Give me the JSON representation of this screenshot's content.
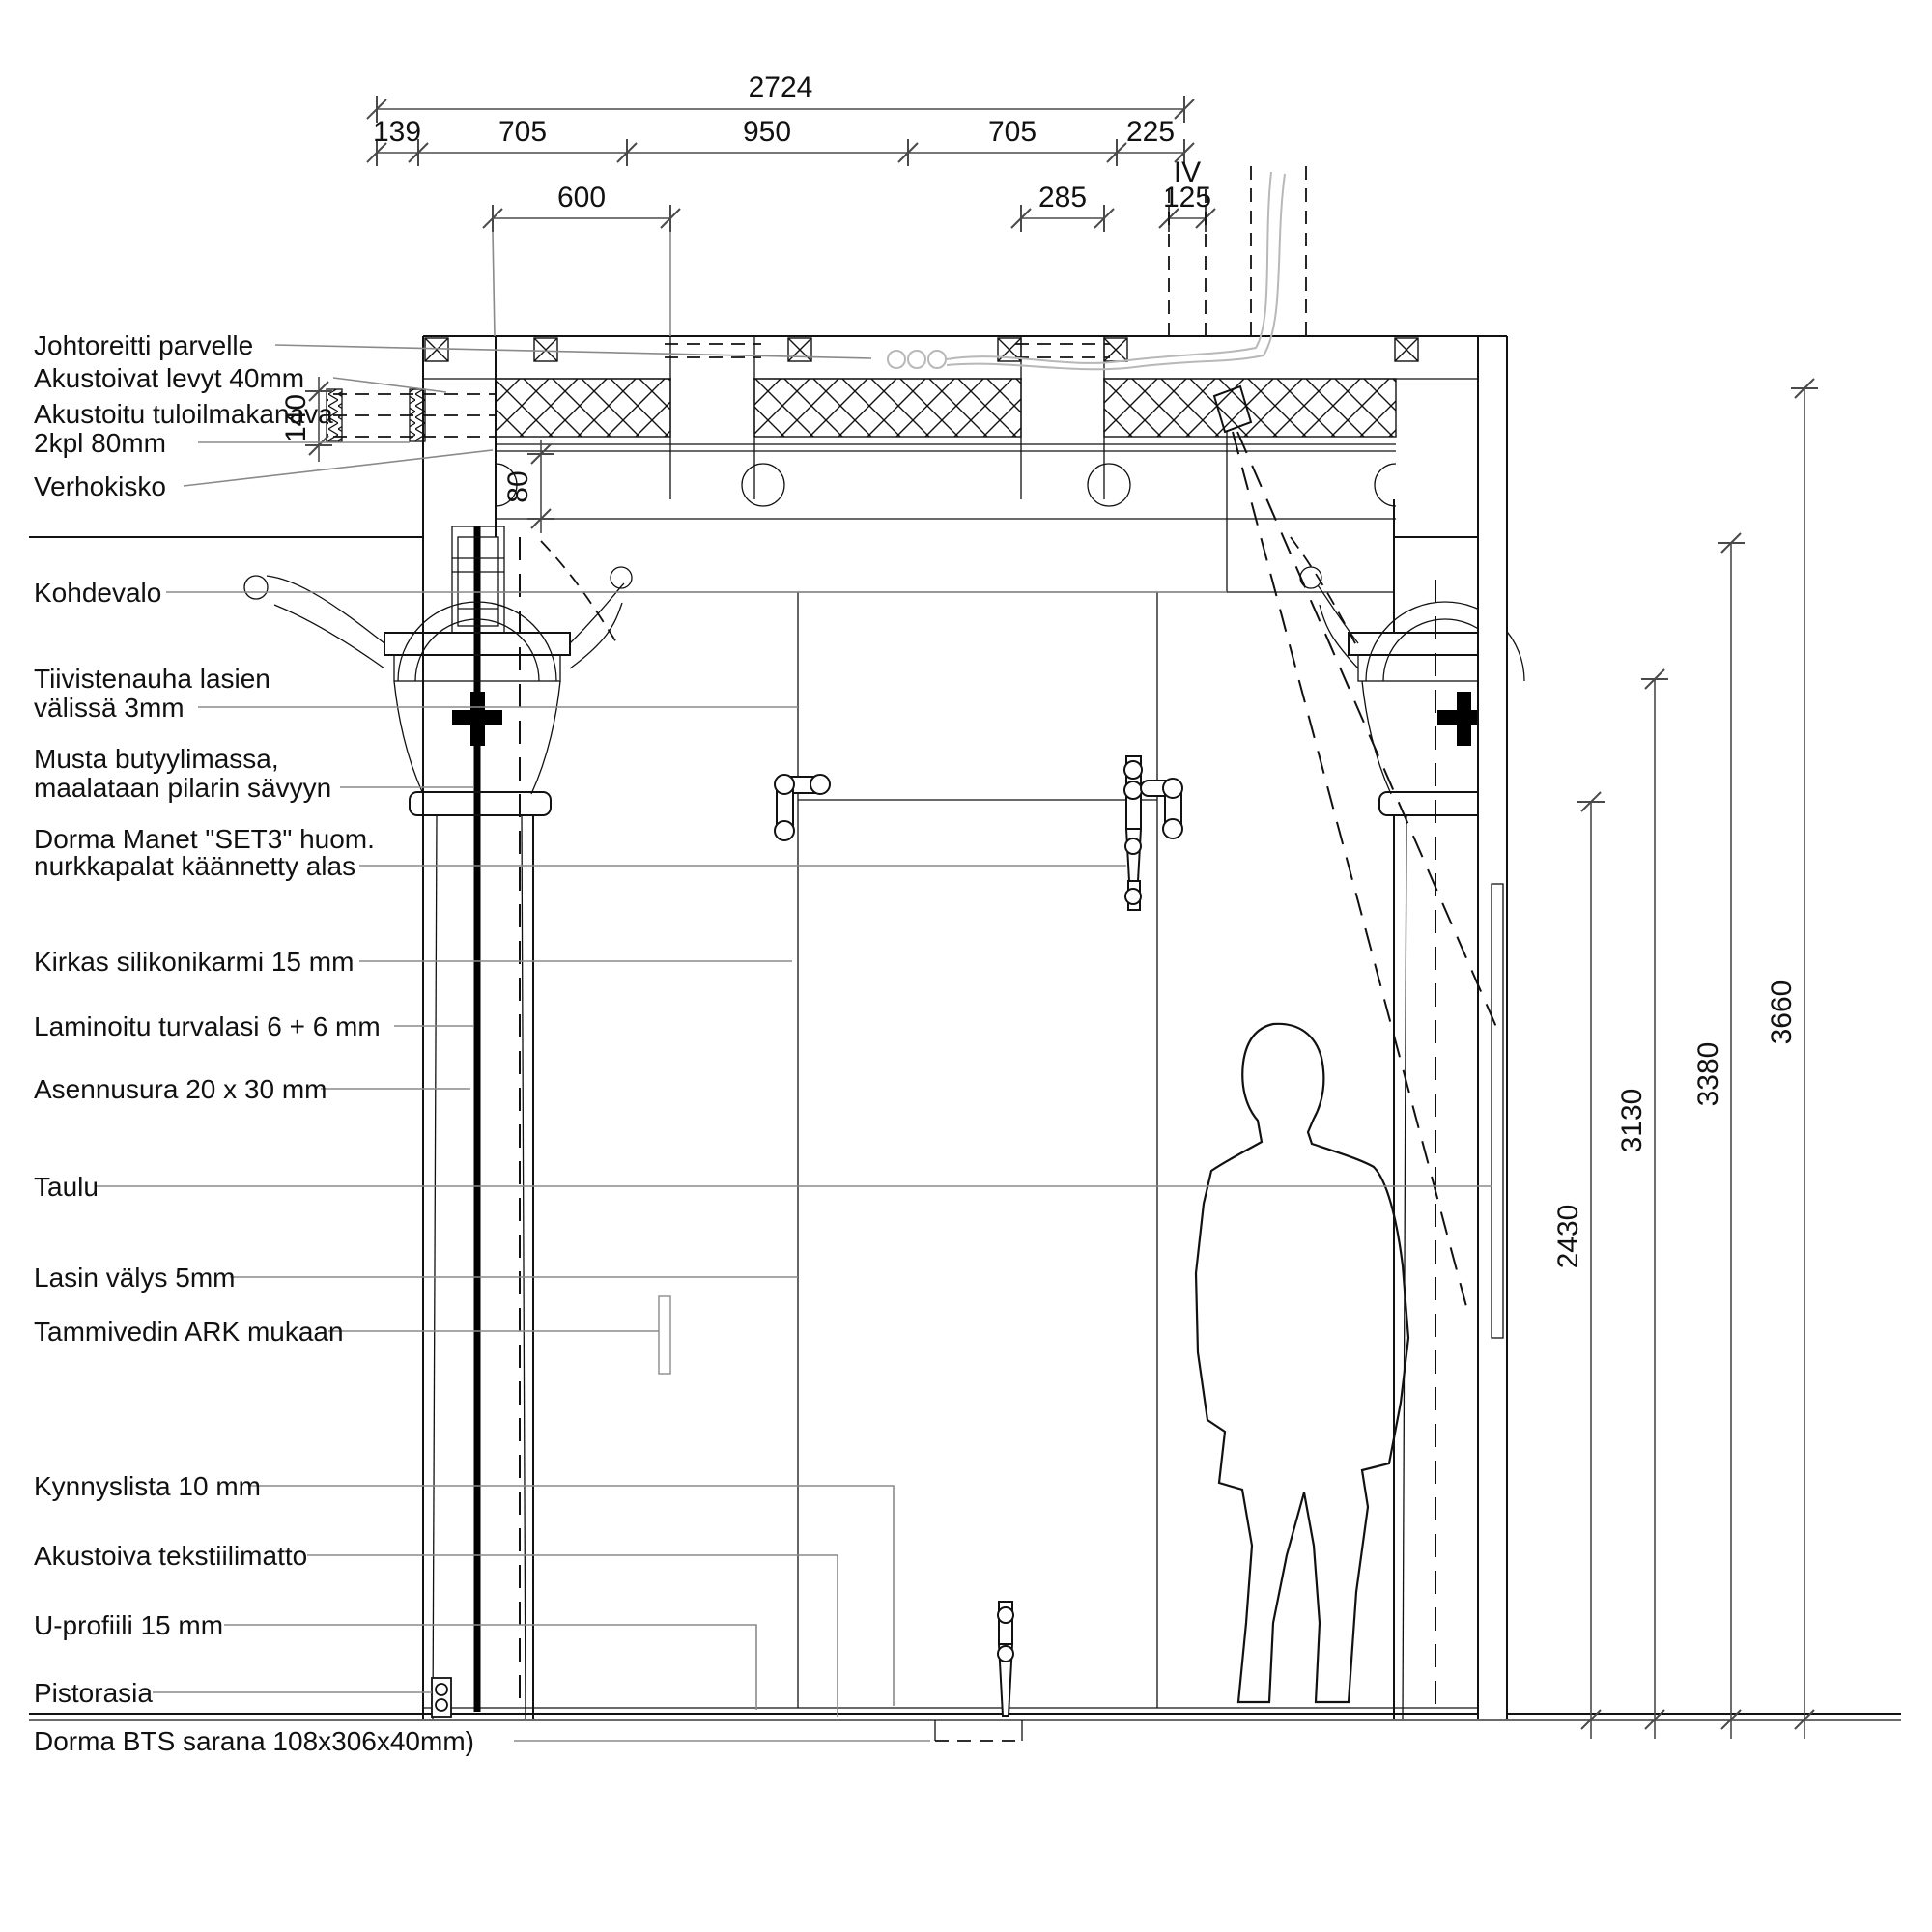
{
  "labels": {
    "left": [
      "Johtoreitti parvelle",
      "Akustoivat levyt 40mm",
      "Akustoitu tuloilmakanava",
      "2kpl 80mm",
      "Verhokisko",
      "Kohdevalo",
      "Tiivistenauha lasien",
      "välissä 3mm",
      "Musta butyylimassa,",
      "maalataan pilarin sävyyn",
      "Dorma Manet \"SET3\" huom.",
      "nurkkapalat käännetty alas",
      "Kirkas silikonikarmi 15 mm",
      "Laminoitu turvalasi 6 + 6 mm",
      "Asennusura 20 x 30 mm",
      "Taulu",
      "Lasin välys 5mm",
      "Tammivedin ARK mukaan",
      "Kynnyslista 10 mm",
      "Akustoiva tekstiilimatto",
      "U-profiili 15 mm",
      "Pistorasia"
    ],
    "bottom": "Dorma BTS sarana 108x306x40mm)"
  },
  "dimensions": {
    "horizontal": {
      "overall": "2724",
      "segments": [
        "139",
        "705",
        "950",
        "705",
        "225"
      ],
      "detail": {
        "d600": "600",
        "d285": "285",
        "d125": "125"
      }
    },
    "vertical": {
      "right": [
        "2430",
        "3130",
        "3380",
        "3660"
      ],
      "left": {
        "d140": "140",
        "d80": "80"
      }
    },
    "marker_iv": "IV"
  }
}
